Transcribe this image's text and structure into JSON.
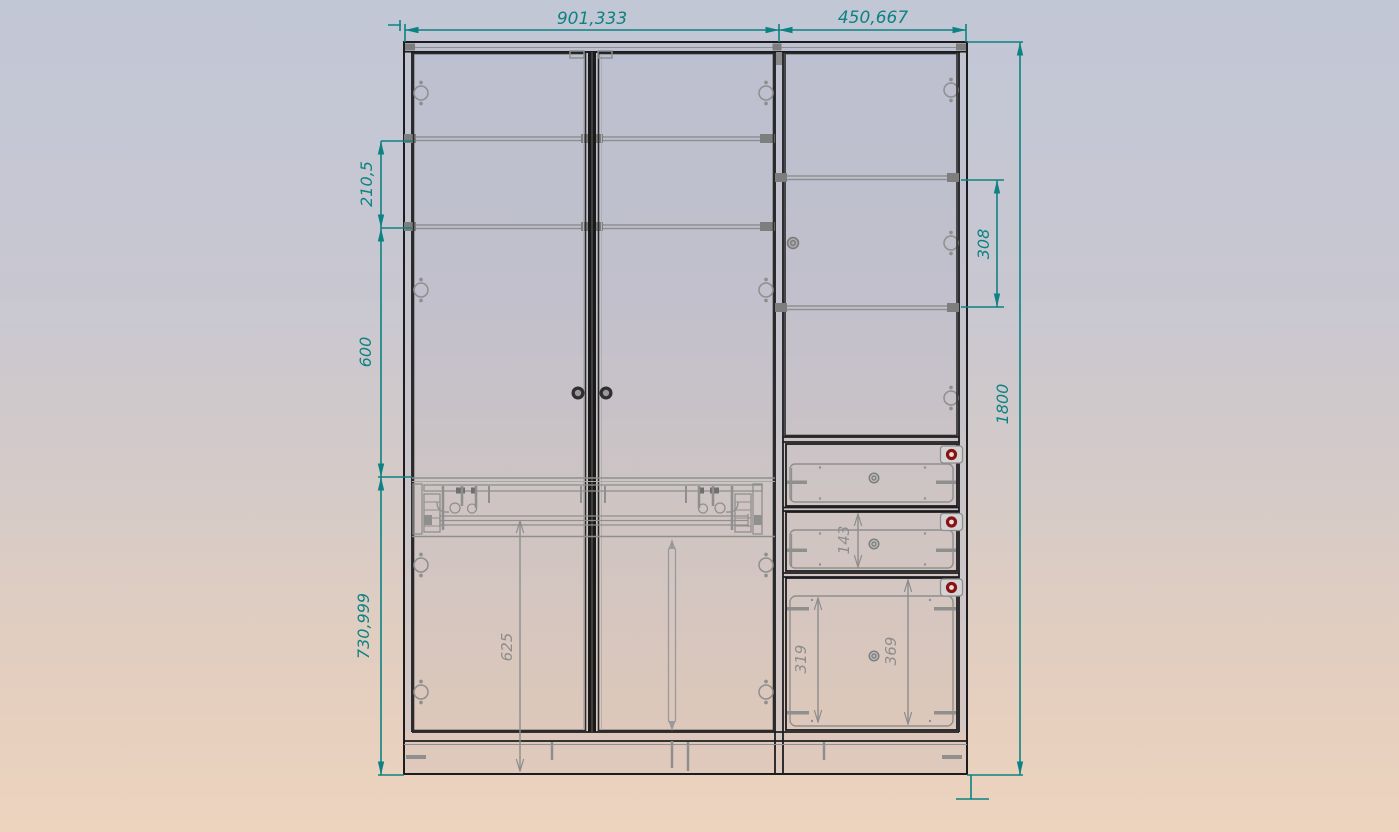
{
  "viewport": {
    "kind": "furniture-cad-front-elevation",
    "subject": "wardrobe with two doors, side door and three drawers"
  },
  "colors": {
    "dimension_teal": "#0d8282",
    "hidden_line_gray": "#8d8d8d",
    "panel_edge_dark": "#1d1d20",
    "drawer_knob_red": "#8c1212",
    "background_top": "#c2c7d6",
    "background_bottom": "#ecd4bf"
  },
  "dims": {
    "width_left_section": "901,333",
    "width_right_section": "450,667",
    "upper_shelf_spacing": "210,5",
    "middle_zone_height": "600",
    "lower_zone_height": "730,999",
    "right_shelf_spacing": "308",
    "overall_height": "1800",
    "middle_drawer_height": "143",
    "lower_door_height": "625",
    "bottom_drawer_opening_height": "319",
    "bottom_drawer_front_height": "369"
  }
}
